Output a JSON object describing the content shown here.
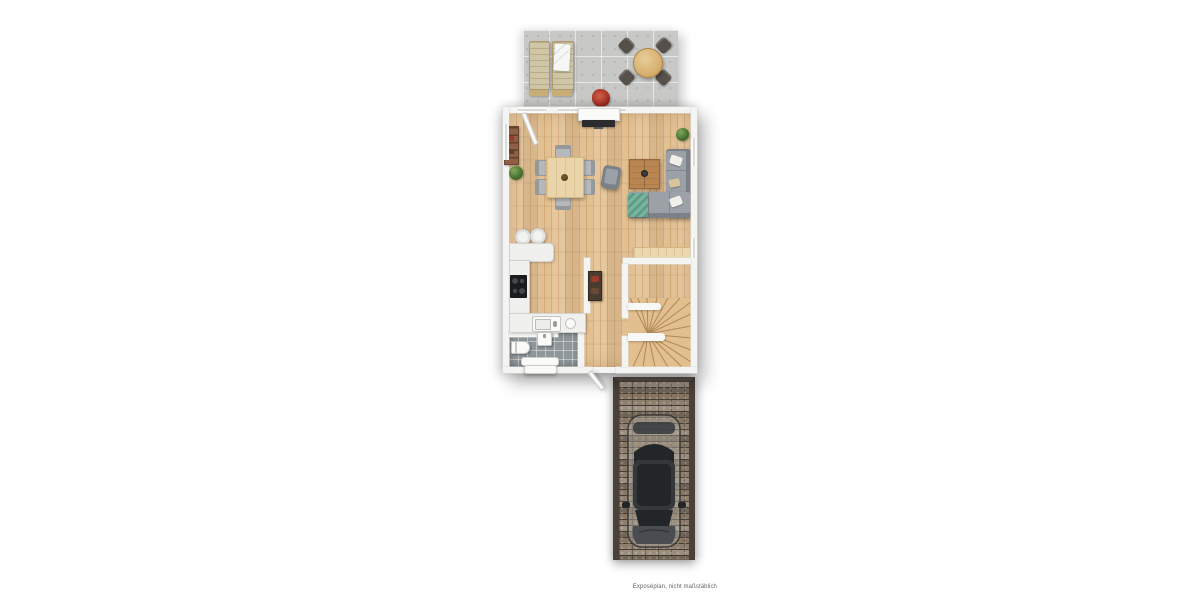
{
  "meta": {
    "disclaimer": "Exposéplan, nicht maßstäblich"
  },
  "scene": {
    "type": "floor-plan-top-view",
    "areas": [
      "terrace",
      "living-dining-room",
      "open-kitchen",
      "bathroom",
      "hallway-with-winder-stairs",
      "entrance",
      "driveway-with-car"
    ],
    "symbols": {
      "terrace": [
        "sun-lounger",
        "sun-lounger-with-towel",
        "round-outdoor-table",
        "outdoor-chair-x4",
        "red-plant"
      ],
      "living": [
        "tv-sideboard",
        "tv",
        "bookshelf",
        "plant-x2",
        "dining-table",
        "dining-chair-x6",
        "armchair",
        "coffee-table",
        "corner-sofa",
        "teal-throw",
        "pillows",
        "wall-bench"
      ],
      "kitchen": [
        "counter-l-shape",
        "cooktop",
        "sink",
        "bowl",
        "bar-stool-x2"
      ],
      "bathroom": [
        "toilet",
        "washbasin",
        "radiator"
      ],
      "hall": [
        "wardrobe",
        "winder-staircase",
        "entrance-door"
      ],
      "outside": [
        "paver-driveway",
        "parked-car"
      ]
    }
  },
  "colors": {
    "wall": "#f4f4f3",
    "wall_edge": "#dcdcda",
    "wall_stub": "#f8f8f7",
    "wood": "#e3c092",
    "terrace": "#c8c9c7",
    "bath": "#8f979b",
    "counter": "#f0f0ee",
    "counter_edge": "#d2d2d0",
    "chair": "#b6b9bc",
    "chair_edge": "#96999c",
    "table_wood": "#e9d5a9",
    "table_edge": "#d3b97f",
    "coffee_wood": "#b98551",
    "shelf_wood": "#8d5f44",
    "bench_wood": "#ead8ae",
    "sofa": "#9ba1a7",
    "sofa_dark": "#7c8187",
    "pillow": "#f1efe9",
    "teal": "#74b09c",
    "plant": "#4a7434",
    "plant_dark": "#2f5420",
    "red_plant": "#a93326",
    "cooktop": "#1b1c1d",
    "white_fix": "#fafaf9",
    "stair_wood": "#e2bf8e",
    "stair_line": "#a87f4e",
    "paver": "#8d7e6d",
    "paver_border": "#4a4138",
    "car_body": "#494d51",
    "car_dark": "#232629",
    "car_mid": "#34383b",
    "text": "#666666"
  }
}
